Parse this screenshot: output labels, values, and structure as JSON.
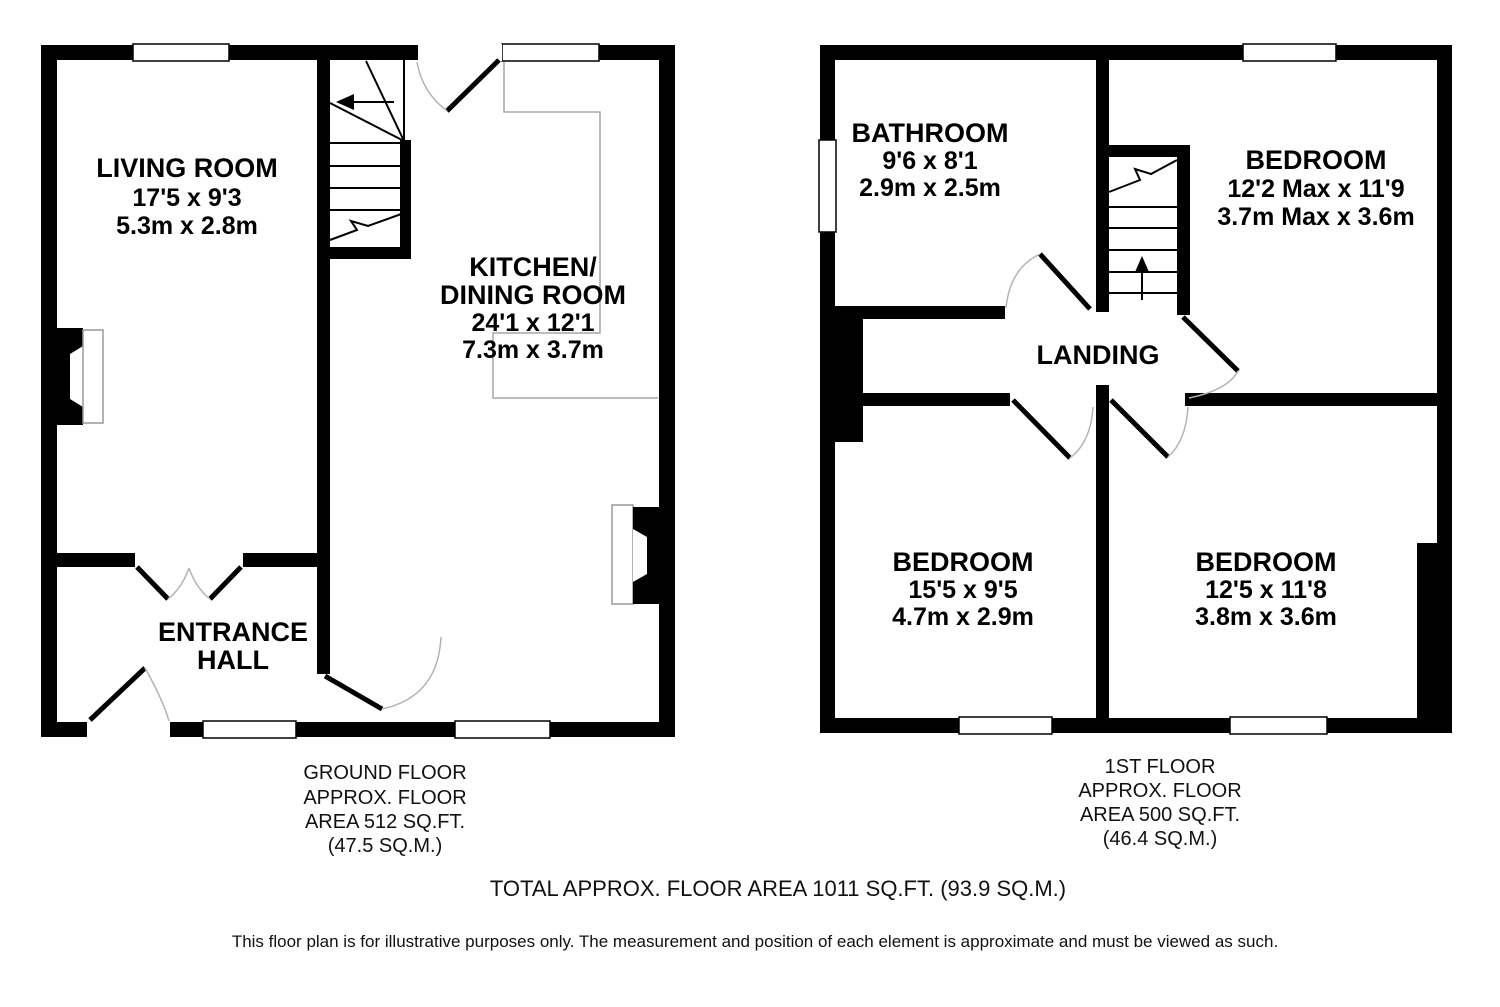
{
  "ground_floor": {
    "living_room": {
      "name": "LIVING ROOM",
      "imperial": "17'5 x 9'3",
      "metric": "5.3m x 2.8m"
    },
    "kitchen": {
      "name_line1": "KITCHEN/",
      "name_line2": "DINING ROOM",
      "imperial": "24'1 x 12'1",
      "metric": "7.3m x 3.7m"
    },
    "entrance_hall": {
      "name_line1": "ENTRANCE",
      "name_line2": "HALL"
    },
    "caption": {
      "line1": "GROUND FLOOR",
      "line2": "APPROX. FLOOR",
      "line3": "AREA 512 SQ.FT.",
      "line4": "(47.5 SQ.M.)"
    }
  },
  "first_floor": {
    "bathroom": {
      "name": "BATHROOM",
      "imperial": "9'6 x 8'1",
      "metric": "2.9m x 2.5m"
    },
    "bedroom_top_right": {
      "name": "BEDROOM",
      "imperial": "12'2 Max x 11'9",
      "metric": "3.7m Max x 3.6m"
    },
    "landing": {
      "name": "LANDING"
    },
    "bedroom_bottom_left": {
      "name": "BEDROOM",
      "imperial": "15'5 x 9'5",
      "metric": "4.7m x 2.9m"
    },
    "bedroom_bottom_right": {
      "name": "BEDROOM",
      "imperial": "12'5 x 11'8",
      "metric": "3.8m x 3.6m"
    },
    "caption": {
      "line1": "1ST FLOOR",
      "line2": "APPROX. FLOOR",
      "line3": "AREA 500 SQ.FT.",
      "line4": "(46.4 SQ.M.)"
    }
  },
  "footer": {
    "total": "TOTAL APPROX. FLOOR AREA 1011 SQ.FT. (93.9 SQ.M.)",
    "disclaimer": "This floor plan is for illustrative purposes only. The measurement and position of each element is approximate and must be viewed as such."
  },
  "colors": {
    "wall": "#000000",
    "arc": "#b3b3b3",
    "counter": "#a6a6a6",
    "background": "#ffffff"
  }
}
